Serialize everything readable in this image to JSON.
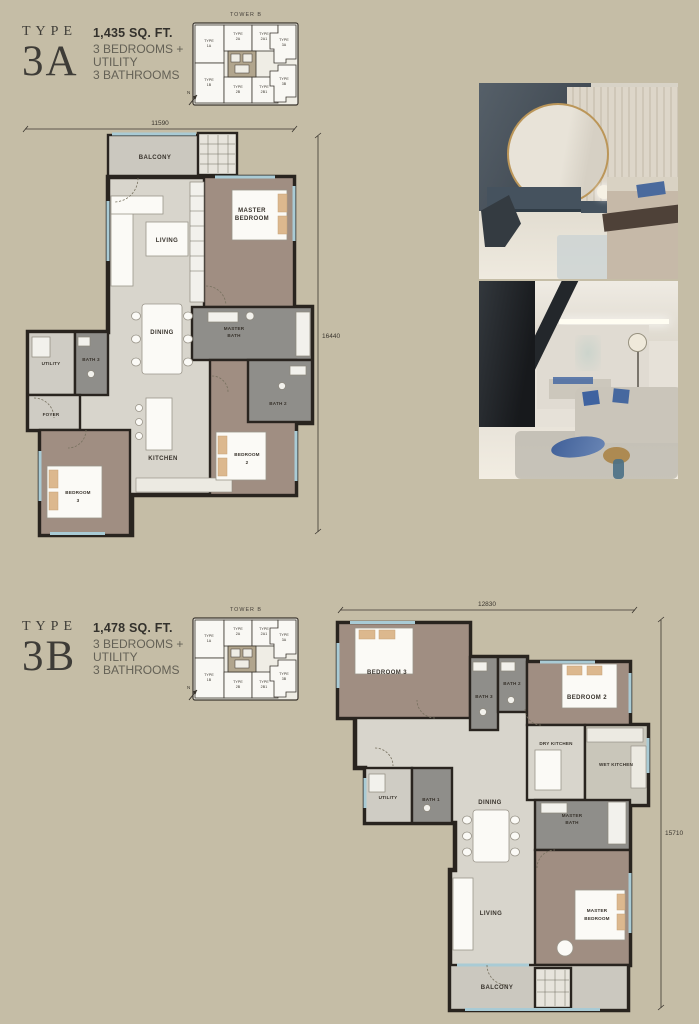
{
  "sections": {
    "a": {
      "type_label": "TYPE",
      "type_code": "3A",
      "area": "1,435 SQ. FT.",
      "specs": {
        "line1": "3 BEDROOMS +",
        "line2": "UTILITY",
        "line3": "3 BATHROOMS"
      },
      "dims": {
        "top": "11590",
        "right": "16440"
      },
      "rooms": {
        "balcony": "BALCONY",
        "living": "LIVING",
        "dining": "DINING",
        "kitchen": "KITCHEN",
        "utility": "UTILITY",
        "foyer": "FOYER",
        "bath3": "BATH 3",
        "bath2": "BATH 2",
        "master_bedroom": [
          "MASTER",
          "BEDROOM"
        ],
        "master_bath": [
          "MASTER",
          "BATH"
        ],
        "bedroom2": [
          "BEDROOM",
          "2"
        ],
        "bedroom3": [
          "BEDROOM",
          "3"
        ]
      }
    },
    "b": {
      "type_label": "TYPE",
      "type_code": "3B",
      "area": "1,478 SQ. FT.",
      "specs": {
        "line1": "3 BEDROOMS +",
        "line2": "UTILITY",
        "line3": "3 BATHROOMS"
      },
      "dims": {
        "top": "12830",
        "right": "15710"
      },
      "rooms": {
        "bedroom3": "BEDROOM 3",
        "bedroom2": "BEDROOM 2",
        "bath3": "BATH 3",
        "bath2": "BATH 2",
        "bath1": "BATH 1",
        "utility": "UTILITY",
        "dry_kitchen": "DRY KITCHEN",
        "wet_kitchen": "WET KITCHEN",
        "dining": "DINING",
        "living": "LIVING",
        "balcony": "BALCONY",
        "master_bath": [
          "MASTER",
          "BATH"
        ],
        "master_bedroom": [
          "MASTER",
          "BEDROOM"
        ]
      }
    }
  },
  "keyplan": {
    "tower": "TOWER B",
    "north": "N",
    "highlight_color": "#8fc2cd",
    "units": [
      {
        "t": "TYPE",
        "c": "1A"
      },
      {
        "t": "TYPE",
        "c": "2A"
      },
      {
        "t": "TYPE",
        "c": "2A1"
      },
      {
        "t": "TYPE",
        "c": "3A"
      },
      {
        "t": "TYPE",
        "c": "1B"
      },
      {
        "t": "TYPE",
        "c": "2B"
      },
      {
        "t": "TYPE",
        "c": "2B1"
      },
      {
        "t": "TYPE",
        "c": "3B"
      }
    ]
  },
  "colors": {
    "background": "#c5bda6",
    "walls": "#29241f",
    "open_floor": "#d8d5cc",
    "bedroom_floor": "#a08e82",
    "bath_floor": "#8f8e8a",
    "window": "#a9cbd5",
    "highlight": "#8fc2cd"
  }
}
